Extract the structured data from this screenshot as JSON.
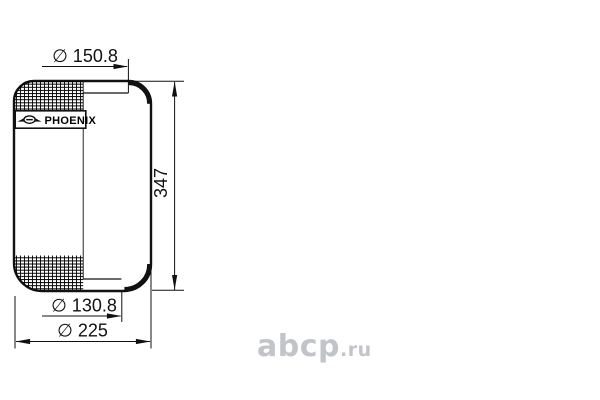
{
  "drawing": {
    "brand_label": "PHOENIX",
    "dim_top_diameter": "∅ 150.8",
    "dim_height": "347",
    "dim_bottom_diameter": "∅ 130.8",
    "dim_overall_diameter": "∅ 225"
  },
  "watermark": {
    "main": "abcp",
    "suffix": ".ru"
  },
  "colors": {
    "line": "#111111",
    "watermark": "#c1c4c8",
    "background": "#ffffff"
  }
}
